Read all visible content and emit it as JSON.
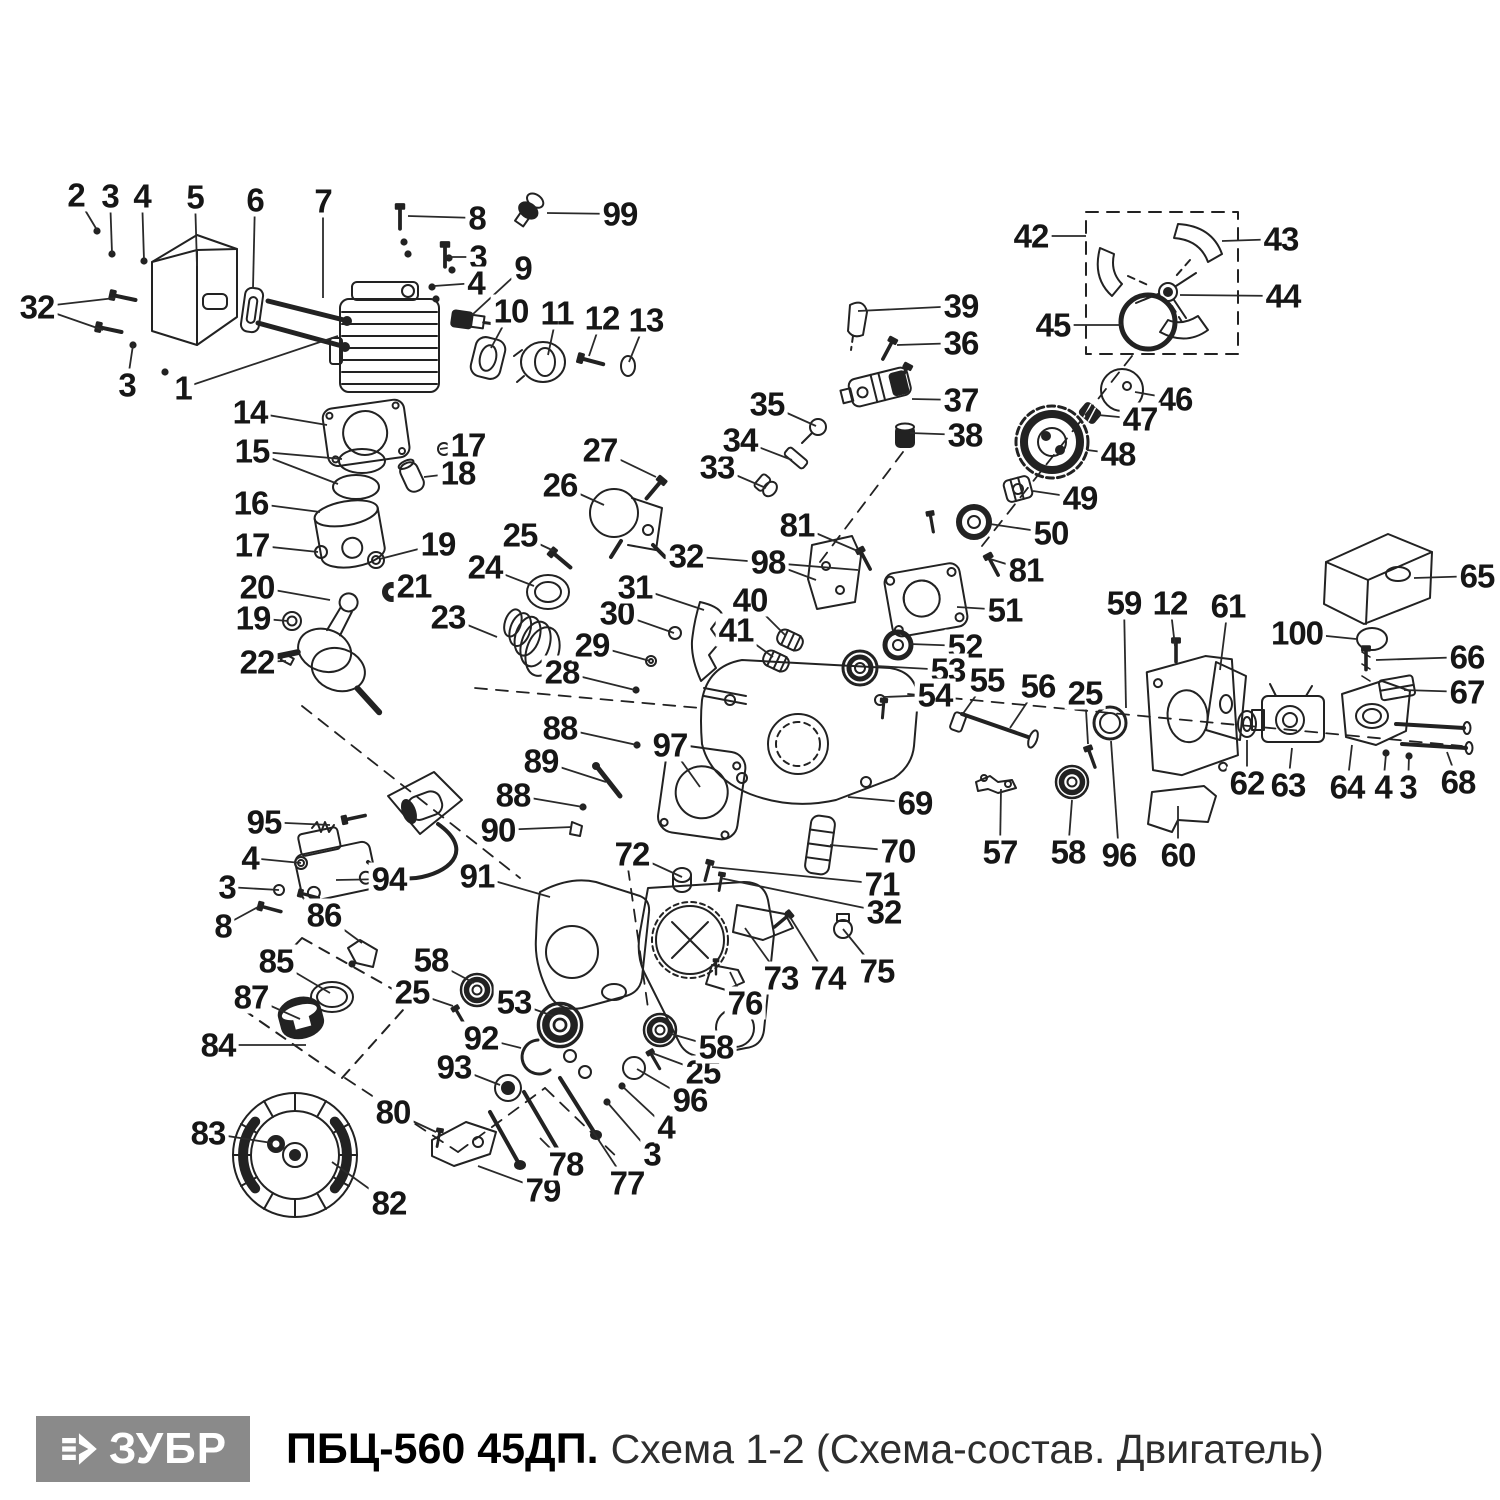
{
  "footer": {
    "brand": "ЗУБР",
    "model": "ПБЦ-560 45ДП.",
    "subtitle": "Схема 1-2 (Схема-состав. Двигатель)",
    "logo_bg": "#8a8a8a",
    "logo_text_color": "#ffffff"
  },
  "diagram": {
    "stroke_color": "#222222",
    "leader_color": "#2a2a2a",
    "labels": [
      {
        "t": "2",
        "x": 76,
        "y": 195,
        "l": [
          [
            97,
            230
          ]
        ]
      },
      {
        "t": "3",
        "x": 110,
        "y": 196,
        "l": [
          [
            112,
            253
          ]
        ]
      },
      {
        "t": "4",
        "x": 142,
        "y": 196,
        "l": [
          [
            144,
            260
          ]
        ]
      },
      {
        "t": "5",
        "x": 195,
        "y": 197,
        "l": [
          [
            197,
            266
          ]
        ]
      },
      {
        "t": "6",
        "x": 255,
        "y": 200,
        "l": [
          [
            253,
            288
          ]
        ]
      },
      {
        "t": "7",
        "x": 323,
        "y": 201,
        "l": [
          [
            323,
            298
          ]
        ]
      },
      {
        "t": "8",
        "x": 477,
        "y": 218,
        "l": [
          [
            408,
            216
          ]
        ]
      },
      {
        "t": "99",
        "x": 620,
        "y": 214,
        "l": [
          [
            547,
            213
          ]
        ]
      },
      {
        "t": "3",
        "x": 478,
        "y": 257,
        "l": [
          [
            447,
            257
          ]
        ]
      },
      {
        "t": "4",
        "x": 476,
        "y": 283,
        "l": [
          [
            434,
            286
          ]
        ]
      },
      {
        "t": "9",
        "x": 523,
        "y": 268,
        "l": [
          [
            472,
            315
          ]
        ]
      },
      {
        "t": "10",
        "x": 511,
        "y": 311,
        "l": [
          [
            491,
            348
          ]
        ]
      },
      {
        "t": "11",
        "x": 557,
        "y": 313,
        "l": [
          [
            548,
            355
          ]
        ]
      },
      {
        "t": "12",
        "x": 602,
        "y": 318,
        "l": [
          [
            589,
            356
          ]
        ]
      },
      {
        "t": "13",
        "x": 646,
        "y": 320,
        "l": [
          [
            629,
            362
          ]
        ]
      },
      {
        "t": "32",
        "x": 37,
        "y": 307,
        "l": [
          [
            115,
            298
          ],
          [
            103,
            330
          ]
        ]
      },
      {
        "t": "3",
        "x": 127,
        "y": 385,
        "l": [
          [
            133,
            345
          ]
        ]
      },
      {
        "t": "1",
        "x": 183,
        "y": 388,
        "l": [
          [
            338,
            336
          ]
        ]
      },
      {
        "t": "14",
        "x": 250,
        "y": 412,
        "l": [
          [
            327,
            425
          ]
        ]
      },
      {
        "t": "15",
        "x": 252,
        "y": 451,
        "l": [
          [
            342,
            459
          ],
          [
            338,
            484
          ]
        ]
      },
      {
        "t": "16",
        "x": 251,
        "y": 503,
        "l": [
          [
            320,
            512
          ]
        ]
      },
      {
        "t": "17",
        "x": 252,
        "y": 545,
        "l": [
          [
            318,
            552
          ]
        ]
      },
      {
        "t": "17",
        "x": 468,
        "y": 445,
        "l": [
          [
            440,
            449
          ]
        ]
      },
      {
        "t": "18",
        "x": 458,
        "y": 473,
        "l": [
          [
            424,
            477
          ]
        ]
      },
      {
        "t": "19",
        "x": 438,
        "y": 544,
        "l": [
          [
            380,
            559
          ]
        ]
      },
      {
        "t": "21",
        "x": 414,
        "y": 586,
        "l": [
          [
            397,
            591
          ]
        ]
      },
      {
        "t": "20",
        "x": 257,
        "y": 587,
        "l": [
          [
            330,
            600
          ]
        ]
      },
      {
        "t": "19",
        "x": 253,
        "y": 618,
        "l": [
          [
            288,
            621
          ]
        ]
      },
      {
        "t": "22",
        "x": 257,
        "y": 662,
        "l": [
          [
            286,
            661
          ]
        ]
      },
      {
        "t": "23",
        "x": 448,
        "y": 617,
        "l": [
          [
            497,
            637
          ]
        ]
      },
      {
        "t": "24",
        "x": 485,
        "y": 567,
        "l": [
          [
            534,
            586
          ]
        ]
      },
      {
        "t": "25",
        "x": 520,
        "y": 535,
        "l": [
          [
            554,
            551
          ]
        ]
      },
      {
        "t": "26",
        "x": 560,
        "y": 485,
        "l": [
          [
            604,
            505
          ]
        ]
      },
      {
        "t": "27",
        "x": 600,
        "y": 450,
        "l": [
          [
            656,
            477
          ]
        ]
      },
      {
        "t": "28",
        "x": 562,
        "y": 672,
        "l": [
          [
            635,
            690
          ]
        ]
      },
      {
        "t": "29",
        "x": 592,
        "y": 645,
        "l": [
          [
            650,
            661
          ]
        ]
      },
      {
        "t": "30",
        "x": 617,
        "y": 613,
        "l": [
          [
            674,
            633
          ]
        ]
      },
      {
        "t": "31",
        "x": 635,
        "y": 587,
        "l": [
          [
            704,
            610
          ]
        ]
      },
      {
        "t": "32",
        "x": 686,
        "y": 556,
        "l": [
          [
            858,
            570
          ]
        ]
      },
      {
        "t": "33",
        "x": 717,
        "y": 467,
        "l": [
          [
            766,
            488
          ]
        ]
      },
      {
        "t": "34",
        "x": 740,
        "y": 440,
        "l": [
          [
            792,
            460
          ]
        ]
      },
      {
        "t": "35",
        "x": 767,
        "y": 404,
        "l": [
          [
            816,
            426
          ]
        ]
      },
      {
        "t": "36",
        "x": 961,
        "y": 343,
        "l": [
          [
            897,
            345
          ]
        ]
      },
      {
        "t": "37",
        "x": 961,
        "y": 400,
        "l": [
          [
            912,
            399
          ]
        ]
      },
      {
        "t": "38",
        "x": 965,
        "y": 435,
        "l": [
          [
            910,
            433
          ]
        ]
      },
      {
        "t": "39",
        "x": 961,
        "y": 306,
        "l": [
          [
            858,
            311
          ]
        ]
      },
      {
        "t": "40",
        "x": 750,
        "y": 600,
        "l": [
          [
            786,
            636
          ]
        ]
      },
      {
        "t": "41",
        "x": 736,
        "y": 630,
        "l": [
          [
            773,
            657
          ]
        ]
      },
      {
        "t": "81",
        "x": 797,
        "y": 525,
        "l": [
          [
            860,
            552
          ]
        ]
      },
      {
        "t": "98",
        "x": 768,
        "y": 562,
        "l": [
          [
            816,
            580
          ]
        ]
      },
      {
        "t": "42",
        "x": 1031,
        "y": 236,
        "l": [
          [
            1086,
            236
          ]
        ]
      },
      {
        "t": "43",
        "x": 1281,
        "y": 239,
        "l": [
          [
            1222,
            241
          ]
        ]
      },
      {
        "t": "44",
        "x": 1283,
        "y": 296,
        "l": [
          [
            1180,
            295
          ]
        ]
      },
      {
        "t": "45",
        "x": 1053,
        "y": 325,
        "l": [
          [
            1122,
            325
          ]
        ]
      },
      {
        "t": "46",
        "x": 1175,
        "y": 399,
        "l": [
          [
            1135,
            392
          ]
        ]
      },
      {
        "t": "47",
        "x": 1140,
        "y": 419,
        "l": [
          [
            1098,
            415
          ]
        ]
      },
      {
        "t": "48",
        "x": 1118,
        "y": 454,
        "l": [
          [
            1087,
            450
          ]
        ]
      },
      {
        "t": "49",
        "x": 1080,
        "y": 498,
        "l": [
          [
            1033,
            491
          ]
        ]
      },
      {
        "t": "50",
        "x": 1051,
        "y": 533,
        "l": [
          [
            990,
            524
          ]
        ]
      },
      {
        "t": "81",
        "x": 1026,
        "y": 570,
        "l": [
          [
            990,
            559
          ]
        ]
      },
      {
        "t": "51",
        "x": 1005,
        "y": 610,
        "l": [
          [
            957,
            607
          ]
        ]
      },
      {
        "t": "52",
        "x": 965,
        "y": 646,
        "l": [
          [
            910,
            644
          ]
        ]
      },
      {
        "t": "53",
        "x": 948,
        "y": 670,
        "l": [
          [
            876,
            666
          ]
        ]
      },
      {
        "t": "54",
        "x": 935,
        "y": 695,
        "l": [
          [
            884,
            697
          ]
        ]
      },
      {
        "t": "55",
        "x": 987,
        "y": 680,
        "l": [
          [
            962,
            715
          ]
        ]
      },
      {
        "t": "56",
        "x": 1038,
        "y": 686,
        "l": [
          [
            1010,
            728
          ]
        ]
      },
      {
        "t": "25",
        "x": 1085,
        "y": 693,
        "l": [
          [
            1088,
            744
          ]
        ]
      },
      {
        "t": "59",
        "x": 1124,
        "y": 603,
        "l": [
          [
            1126,
            708
          ]
        ]
      },
      {
        "t": "12",
        "x": 1170,
        "y": 603,
        "l": [
          [
            1175,
            646
          ]
        ]
      },
      {
        "t": "61",
        "x": 1228,
        "y": 606,
        "l": [
          [
            1220,
            670
          ]
        ]
      },
      {
        "t": "65",
        "x": 1477,
        "y": 576,
        "l": [
          [
            1414,
            578
          ]
        ]
      },
      {
        "t": "100",
        "x": 1297,
        "y": 633,
        "l": [
          [
            1356,
            639
          ]
        ]
      },
      {
        "t": "66",
        "x": 1467,
        "y": 657,
        "l": [
          [
            1376,
            660
          ]
        ]
      },
      {
        "t": "67",
        "x": 1467,
        "y": 692,
        "l": [
          [
            1404,
            690
          ]
        ]
      },
      {
        "t": "62",
        "x": 1247,
        "y": 783,
        "l": [
          [
            1247,
            740
          ]
        ]
      },
      {
        "t": "63",
        "x": 1288,
        "y": 785,
        "l": [
          [
            1292,
            748
          ]
        ]
      },
      {
        "t": "64",
        "x": 1347,
        "y": 787,
        "l": [
          [
            1352,
            745
          ]
        ]
      },
      {
        "t": "4",
        "x": 1383,
        "y": 787,
        "l": [
          [
            1386,
            754
          ]
        ]
      },
      {
        "t": "3",
        "x": 1408,
        "y": 787,
        "l": [
          [
            1409,
            756
          ]
        ]
      },
      {
        "t": "68",
        "x": 1458,
        "y": 782,
        "l": [
          [
            1447,
            752
          ]
        ]
      },
      {
        "t": "96",
        "x": 1119,
        "y": 855,
        "l": [
          [
            1111,
            741
          ]
        ]
      },
      {
        "t": "60",
        "x": 1178,
        "y": 855,
        "l": [
          [
            1178,
            806
          ]
        ]
      },
      {
        "t": "57",
        "x": 1000,
        "y": 852,
        "l": [
          [
            1001,
            789
          ]
        ]
      },
      {
        "t": "58",
        "x": 1068,
        "y": 852,
        "l": [
          [
            1072,
            800
          ]
        ]
      },
      {
        "t": "69",
        "x": 915,
        "y": 803,
        "l": [
          [
            848,
            797
          ]
        ]
      },
      {
        "t": "70",
        "x": 898,
        "y": 851,
        "l": [
          [
            830,
            845
          ]
        ]
      },
      {
        "t": "71",
        "x": 882,
        "y": 884,
        "l": [
          [
            712,
            867
          ]
        ]
      },
      {
        "t": "32",
        "x": 884,
        "y": 912,
        "l": [
          [
            720,
            878
          ]
        ]
      },
      {
        "t": "72",
        "x": 632,
        "y": 854,
        "l": [
          [
            682,
            877
          ]
        ]
      },
      {
        "t": "73",
        "x": 781,
        "y": 978,
        "l": [
          [
            745,
            928
          ]
        ]
      },
      {
        "t": "74",
        "x": 828,
        "y": 978,
        "l": [
          [
            790,
            917
          ]
        ]
      },
      {
        "t": "75",
        "x": 877,
        "y": 971,
        "l": [
          [
            843,
            929
          ]
        ]
      },
      {
        "t": "76",
        "x": 745,
        "y": 1003,
        "l": [
          [
            730,
            972
          ]
        ]
      },
      {
        "t": "88",
        "x": 560,
        "y": 728,
        "l": [
          [
            637,
            745
          ]
        ]
      },
      {
        "t": "89",
        "x": 541,
        "y": 761,
        "l": [
          [
            606,
            782
          ]
        ]
      },
      {
        "t": "88",
        "x": 513,
        "y": 795,
        "l": [
          [
            583,
            807
          ]
        ]
      },
      {
        "t": "90",
        "x": 498,
        "y": 830,
        "l": [
          [
            572,
            827
          ]
        ]
      },
      {
        "t": "97",
        "x": 670,
        "y": 745,
        "l": [
          [
            700,
            787
          ]
        ]
      },
      {
        "t": "91",
        "x": 477,
        "y": 876,
        "l": [
          [
            550,
            897
          ]
        ]
      },
      {
        "t": "95",
        "x": 264,
        "y": 822,
        "l": [
          [
            330,
            825
          ]
        ]
      },
      {
        "t": "4",
        "x": 250,
        "y": 858,
        "l": [
          [
            301,
            863
          ]
        ]
      },
      {
        "t": "3",
        "x": 227,
        "y": 887,
        "l": [
          [
            279,
            890
          ]
        ]
      },
      {
        "t": "8",
        "x": 223,
        "y": 926,
        "l": [
          [
            258,
            907
          ]
        ]
      },
      {
        "t": "94",
        "x": 389,
        "y": 879,
        "l": [
          [
            336,
            880
          ]
        ]
      },
      {
        "t": "86",
        "x": 324,
        "y": 915,
        "l": [
          [
            362,
            943
          ]
        ]
      },
      {
        "t": "85",
        "x": 276,
        "y": 961,
        "l": [
          [
            330,
            993
          ]
        ]
      },
      {
        "t": "87",
        "x": 251,
        "y": 997,
        "l": [
          [
            300,
            1019
          ]
        ]
      },
      {
        "t": "84",
        "x": 218,
        "y": 1045,
        "l": [
          [
            306,
            1045
          ]
        ]
      },
      {
        "t": "58",
        "x": 431,
        "y": 960,
        "l": [
          [
            474,
            983
          ]
        ]
      },
      {
        "t": "25",
        "x": 412,
        "y": 992,
        "l": [
          [
            453,
            1006
          ]
        ]
      },
      {
        "t": "92",
        "x": 481,
        "y": 1038,
        "l": [
          [
            521,
            1048
          ]
        ]
      },
      {
        "t": "93",
        "x": 454,
        "y": 1067,
        "l": [
          [
            500,
            1085
          ]
        ]
      },
      {
        "t": "53",
        "x": 514,
        "y": 1002,
        "l": [
          [
            553,
            1016
          ]
        ]
      },
      {
        "t": "80",
        "x": 393,
        "y": 1112,
        "l": [
          [
            436,
            1132
          ]
        ]
      },
      {
        "t": "83",
        "x": 208,
        "y": 1133,
        "l": [
          [
            272,
            1143
          ]
        ]
      },
      {
        "t": "82",
        "x": 389,
        "y": 1203,
        "l": [
          [
            332,
            1162
          ]
        ]
      },
      {
        "t": "79",
        "x": 543,
        "y": 1190,
        "l": [
          [
            478,
            1166
          ]
        ]
      },
      {
        "t": "78",
        "x": 566,
        "y": 1164,
        "l": [
          [
            540,
            1138
          ]
        ]
      },
      {
        "t": "77",
        "x": 627,
        "y": 1183,
        "l": [
          [
            592,
            1130
          ]
        ]
      },
      {
        "t": "3",
        "x": 652,
        "y": 1154,
        "l": [
          [
            607,
            1102
          ]
        ]
      },
      {
        "t": "4",
        "x": 666,
        "y": 1127,
        "l": [
          [
            622,
            1086
          ]
        ]
      },
      {
        "t": "96",
        "x": 690,
        "y": 1100,
        "l": [
          [
            637,
            1069
          ]
        ]
      },
      {
        "t": "25",
        "x": 703,
        "y": 1072,
        "l": [
          [
            652,
            1053
          ]
        ]
      },
      {
        "t": "58",
        "x": 716,
        "y": 1047,
        "l": [
          [
            668,
            1033
          ]
        ]
      }
    ]
  }
}
